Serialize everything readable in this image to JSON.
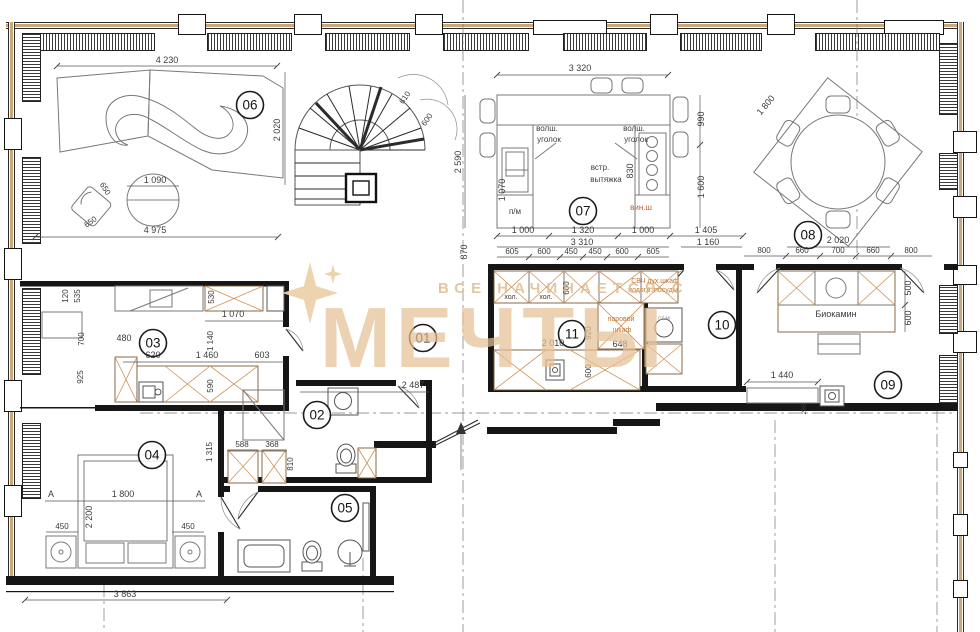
{
  "watermark": {
    "line1": "ВСЕ НАЧИНАЕТСЯ С",
    "line2": "МЕЧТЫ",
    "color": "#e5c398"
  },
  "colors": {
    "annotation_orange": "#c4742f",
    "hatch_orange": "#cf9357",
    "glazing_tan": "#c9a87b",
    "wall_black": "#161616"
  },
  "rooms": {
    "r01": "01",
    "r02": "02",
    "r03": "03",
    "r04": "04",
    "r05": "05",
    "r06": "06",
    "r07": "07",
    "r08": "08",
    "r09": "09",
    "r10": "10",
    "r11": "11"
  },
  "labels": {
    "volsh_a1": "волш.",
    "volsh_a2": "уголок",
    "volsh_b1": "волш.",
    "volsh_b2": "уголок",
    "vstr1": "встр.",
    "vstr2": "вытяжка",
    "pm": "п/м",
    "vinsh": "вин.ш",
    "hol1": "хол.",
    "hol2": "хол.",
    "svch": "СВЧ дух.шкаф",
    "podogrev": "подогр. посуды",
    "parovoy1": "паровой",
    "parovoy2": "шкаф",
    "stm": "ст.м",
    "biokamin": "Биокамин",
    "secA1": "А",
    "secA2": "А"
  },
  "dims": {
    "top_4230": "4 230",
    "left_4975": "4 975",
    "bath_1090": "1 090",
    "chair_650a": "650",
    "chair_650b": "650",
    "stair_2020": "2 020",
    "stair_610": "610",
    "stair_600": "600",
    "kit_3320": "3 320",
    "kit_2590": "2 590",
    "kit_990": "990",
    "kit_1600": "1 600",
    "kit_1070": "1 070",
    "kit_830": "830",
    "kit_1000a": "1 000",
    "kit_1320": "1 320",
    "kit_1000b": "1 000",
    "kit_1405": "1 405",
    "kit_3310": "3 310",
    "kit_1160": "1 160",
    "kit_870": "870",
    "kit_605a": "605",
    "kit_600a": "600",
    "kit_450a": "450",
    "kit_450b": "450",
    "kit_600b": "600",
    "kit_605b": "605",
    "din_1800": "1 800",
    "din_2020": "2 020",
    "din_800a": "800",
    "din_660a": "660",
    "din_700": "700",
    "din_660b": "660",
    "din_800b": "800",
    "bio_500": "500",
    "bio_600": "600",
    "bio_1440": "1 440",
    "bio_285": "285",
    "p11_600": "600",
    "p11_648": "648",
    "p11_2010": "2 010",
    "p11_920": "920",
    "p11_600b": "600",
    "cl_120": "120",
    "cl_535": "535",
    "cl_530": "530",
    "cl_1070": "1 070",
    "cl_700": "700",
    "cl_480": "480",
    "cl_1140": "1 140",
    "cl_620": "620",
    "cl_1460": "1 460",
    "cl_603": "603",
    "cl_925": "925",
    "cl_590": "590",
    "w_588": "588",
    "w_368": "368",
    "w_810": "810",
    "w_1315": "1 315",
    "bed_1800": "1 800",
    "bed_2200": "2 200",
    "bed_450a": "450",
    "bed_450b": "450",
    "bot_3863": "3 863",
    "hall_2487": "2 487"
  }
}
